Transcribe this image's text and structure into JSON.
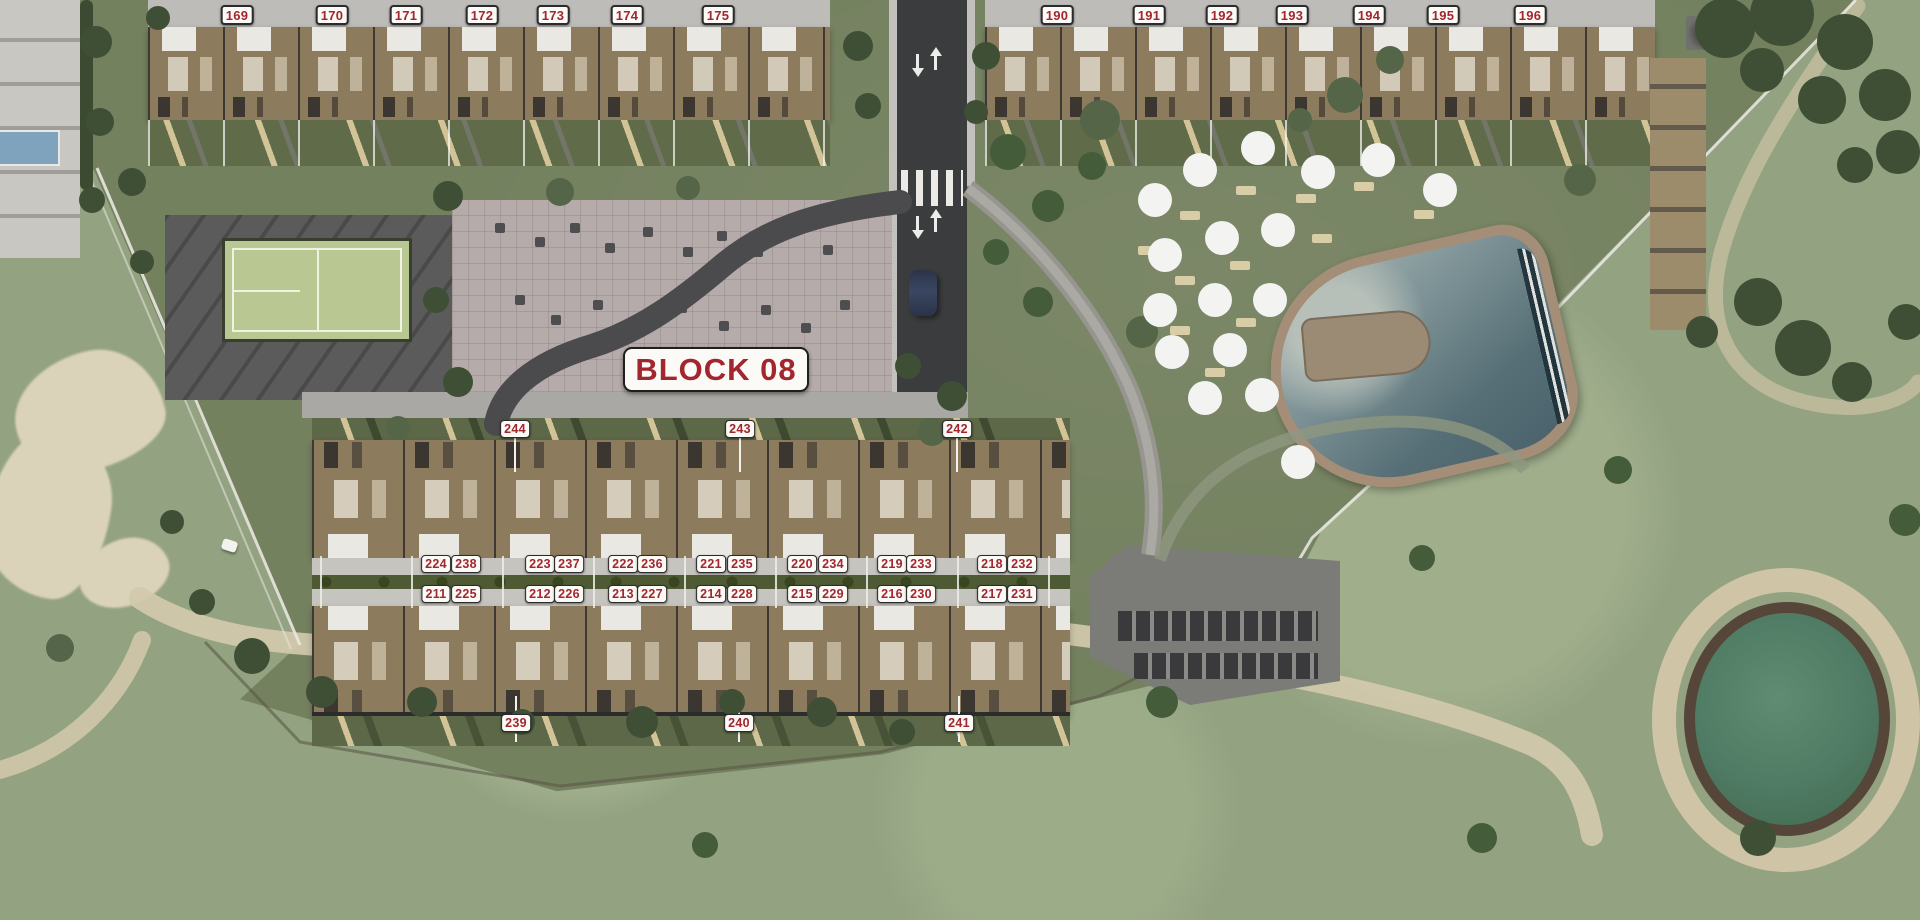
{
  "plan": {
    "block_badge": {
      "label": "BLOCK 08"
    },
    "colors": {
      "label_text": "#a1262e",
      "label_bg": "#fbfaf7",
      "label_border": "#2b2b2b"
    },
    "label_groups": [
      {
        "id": "building-a-street-row",
        "y": 5,
        "size": "md",
        "items": [
          {
            "t": "169",
            "x": 237
          },
          {
            "t": "170",
            "x": 332
          },
          {
            "t": "171",
            "x": 406
          },
          {
            "t": "172",
            "x": 482
          },
          {
            "t": "173",
            "x": 553
          },
          {
            "t": "174",
            "x": 627
          },
          {
            "t": "175",
            "x": 718
          }
        ]
      },
      {
        "id": "building-b-street-row",
        "y": 5,
        "size": "md",
        "items": [
          {
            "t": "190",
            "x": 1057
          },
          {
            "t": "191",
            "x": 1149
          },
          {
            "t": "192",
            "x": 1222
          },
          {
            "t": "193",
            "x": 1292
          },
          {
            "t": "194",
            "x": 1369
          },
          {
            "t": "195",
            "x": 1443
          },
          {
            "t": "196",
            "x": 1530
          }
        ]
      },
      {
        "id": "block08-north-row",
        "y": 420,
        "size": "sm",
        "items": [
          {
            "t": "244",
            "x": 515
          },
          {
            "t": "243",
            "x": 740
          },
          {
            "t": "242",
            "x": 957
          }
        ]
      },
      {
        "id": "block08-upper-walk-row",
        "y": 555,
        "size": "sm",
        "items": [
          {
            "t": "224",
            "x": 436
          },
          {
            "t": "238",
            "x": 466
          },
          {
            "t": "223",
            "x": 540
          },
          {
            "t": "237",
            "x": 569
          },
          {
            "t": "222",
            "x": 623
          },
          {
            "t": "236",
            "x": 652
          },
          {
            "t": "221",
            "x": 711
          },
          {
            "t": "235",
            "x": 742
          },
          {
            "t": "220",
            "x": 802
          },
          {
            "t": "234",
            "x": 833
          },
          {
            "t": "219",
            "x": 892
          },
          {
            "t": "233",
            "x": 921
          },
          {
            "t": "218",
            "x": 992
          },
          {
            "t": "232",
            "x": 1022
          }
        ]
      },
      {
        "id": "block08-lower-walk-row",
        "y": 585,
        "size": "sm",
        "items": [
          {
            "t": "211",
            "x": 436
          },
          {
            "t": "225",
            "x": 466
          },
          {
            "t": "212",
            "x": 540
          },
          {
            "t": "226",
            "x": 569
          },
          {
            "t": "213",
            "x": 623
          },
          {
            "t": "227",
            "x": 652
          },
          {
            "t": "214",
            "x": 711
          },
          {
            "t": "228",
            "x": 742
          },
          {
            "t": "215",
            "x": 802
          },
          {
            "t": "229",
            "x": 833
          },
          {
            "t": "216",
            "x": 892
          },
          {
            "t": "230",
            "x": 921
          },
          {
            "t": "217",
            "x": 992
          },
          {
            "t": "231",
            "x": 1022
          }
        ]
      },
      {
        "id": "block08-south-row",
        "y": 714,
        "size": "sm",
        "items": [
          {
            "t": "239",
            "x": 516
          },
          {
            "t": "240",
            "x": 739
          },
          {
            "t": "241",
            "x": 959
          }
        ]
      }
    ]
  }
}
